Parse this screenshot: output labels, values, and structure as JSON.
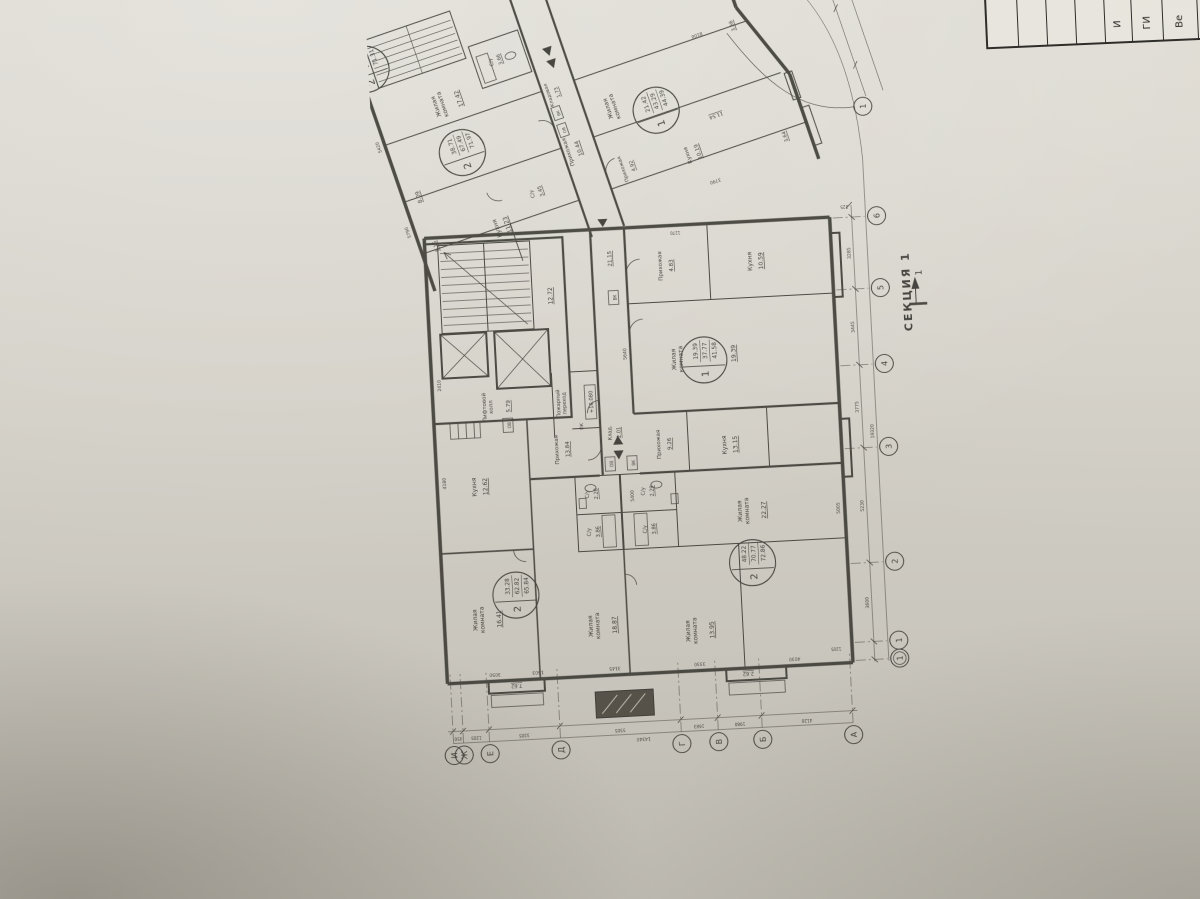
{
  "photo": {
    "paper_color": "#d3d0c7",
    "line_color": "#3a3832",
    "shadow_color": "rgba(70,63,54,0.30)"
  },
  "section": {
    "label": "СЕКЦИЯ 1",
    "mark": "1"
  },
  "title_block": {
    "cells": [
      "",
      "",
      "",
      "",
      "И",
      "ГИ",
      "Ве",
      ""
    ]
  },
  "axis_letters": [
    {
      "t": "И",
      "y": 50
    },
    {
      "t": "Ж",
      "y": 60
    },
    {
      "t": "Е",
      "y": 86
    },
    {
      "t": "Д",
      "y": 157
    },
    {
      "t": "Г",
      "y": 278
    },
    {
      "t": "В",
      "y": 315
    },
    {
      "t": "Б",
      "y": 359
    },
    {
      "t": "А",
      "y": 450
    }
  ],
  "axis_numbers": [
    {
      "t": "6",
      "x": 545
    },
    {
      "t": "5",
      "x": 473
    },
    {
      "t": "4",
      "x": 397
    },
    {
      "t": "3",
      "x": 314
    },
    {
      "t": "2",
      "x": 199
    },
    {
      "t": "1",
      "x": 120
    },
    {
      "t": "1",
      "x": 102,
      "double": true
    },
    {
      "t": "1",
      "x": 655,
      "y": 492,
      "leader": true
    }
  ],
  "stamps": [
    {
      "rooms": "2",
      "a": "33.28",
      "b": "62.82",
      "c": "65.84",
      "x": 185,
      "y": 120
    },
    {
      "rooms": "2",
      "a": "48.22",
      "b": "70.77",
      "c": "72.86",
      "x": 205,
      "y": 358
    },
    {
      "rooms": "1",
      "a": "19.39",
      "b": "37.77",
      "c": "41.58",
      "x": 410,
      "y": 320
    },
    {
      "rooms": "2",
      "a": "38.71",
      "b": "67.49",
      "c": "71.97",
      "x": 668,
      "y": 118,
      "g": "s2"
    },
    {
      "rooms": "1",
      "a": "21.42",
      "b": "43.29",
      "c": "44.39",
      "x": 645,
      "y": 315,
      "g": "s2"
    },
    {
      "rooms": "2",
      "a": "38.71",
      "b": "67.43",
      "c": "71.31",
      "x": 778,
      "y": 54,
      "g": "s2"
    }
  ],
  "plan_labels": [
    {
      "t": "Жилая\nкомната",
      "x": 162,
      "y": 80,
      "s": 6
    },
    {
      "t": "16.41",
      "x": 162,
      "y": 104,
      "s": 6,
      "u": 1
    },
    {
      "t": "Кухня",
      "x": 295,
      "y": 86,
      "s": 6
    },
    {
      "t": "12.62",
      "x": 295,
      "y": 97,
      "s": 6,
      "u": 1
    },
    {
      "t": "Жилая\nкомната",
      "x": 150,
      "y": 195,
      "s": 6
    },
    {
      "t": "18.87",
      "x": 150,
      "y": 219,
      "s": 6,
      "u": 1
    },
    {
      "t": "Прихожая",
      "x": 328,
      "y": 170,
      "s": 5.5
    },
    {
      "t": "13.84",
      "x": 328,
      "y": 181,
      "s": 5.5,
      "u": 1
    },
    {
      "t": "Жилая\nкомната",
      "x": 140,
      "y": 292,
      "s": 6
    },
    {
      "t": "13.95",
      "x": 140,
      "y": 316,
      "s": 6,
      "u": 1
    },
    {
      "t": "Жилая\nкомната",
      "x": 257,
      "y": 350,
      "s": 6
    },
    {
      "t": "22.27",
      "x": 257,
      "y": 374,
      "s": 6,
      "u": 1
    },
    {
      "t": "Кухня",
      "x": 324,
      "y": 338,
      "s": 6
    },
    {
      "t": "13.15",
      "x": 324,
      "y": 349,
      "s": 6,
      "u": 1
    },
    {
      "t": "Прихожая",
      "x": 328,
      "y": 272,
      "s": 5.5
    },
    {
      "t": "9.26",
      "x": 328,
      "y": 283,
      "s": 5.5,
      "u": 1
    },
    {
      "t": "Клад.",
      "x": 342,
      "y": 224,
      "s": 5
    },
    {
      "t": "2.01",
      "x": 342,
      "y": 233,
      "s": 5,
      "u": 1
    },
    {
      "t": "С/у",
      "x": 282,
      "y": 198,
      "s": 5
    },
    {
      "t": "2.28",
      "x": 282,
      "y": 207,
      "s": 5,
      "u": 1
    },
    {
      "t": "С/у",
      "x": 282,
      "y": 254,
      "s": 5
    },
    {
      "t": "2.29",
      "x": 282,
      "y": 263,
      "s": 5,
      "u": 1
    },
    {
      "t": "С/у",
      "x": 244,
      "y": 198,
      "s": 5
    },
    {
      "t": "3.86",
      "x": 244,
      "y": 207,
      "s": 5,
      "u": 1
    },
    {
      "t": "С/у",
      "x": 244,
      "y": 254,
      "s": 5
    },
    {
      "t": "3.86",
      "x": 244,
      "y": 263,
      "s": 5,
      "u": 1
    },
    {
      "t": "ОВ",
      "x": 311,
      "y": 224,
      "s": 4.2
    },
    {
      "t": "ВК",
      "x": 311,
      "y": 246,
      "s": 4.2
    },
    {
      "t": "ОВ",
      "x": 355,
      "y": 124,
      "s": 4.2
    },
    {
      "t": "ВК",
      "x": 477,
      "y": 236,
      "s": 4.2
    },
    {
      "t": "Лифтовой\nхолл",
      "x": 374,
      "y": 100,
      "s": 5.5
    },
    {
      "t": "5.79",
      "x": 374,
      "y": 124,
      "s": 5.5,
      "u": 1
    },
    {
      "t": "Пожарный\nпереход",
      "x": 374,
      "y": 174,
      "s": 5
    },
    {
      "t": "+16.080",
      "x": 374,
      "y": 207,
      "s": 5.2,
      "box": 1
    },
    {
      "t": "ПК",
      "x": 350,
      "y": 196,
      "s": 4.5
    },
    {
      "t": "12.72",
      "x": 482,
      "y": 172,
      "s": 6,
      "u": 1
    },
    {
      "t": "21.15",
      "x": 516,
      "y": 233,
      "s": 5.5,
      "u": 1
    },
    {
      "t": "Жилая\nкомната",
      "x": 412,
      "y": 292,
      "s": 6
    },
    {
      "t": "19.39",
      "x": 415,
      "y": 352,
      "s": 6,
      "u": 1
    },
    {
      "t": "Прихожая",
      "x": 506,
      "y": 283,
      "s": 5.5
    },
    {
      "t": "4.83",
      "x": 506,
      "y": 294,
      "s": 5.5,
      "u": 1
    },
    {
      "t": "Кухня",
      "x": 506,
      "y": 373,
      "s": 6
    },
    {
      "t": "10.59",
      "x": 506,
      "y": 384,
      "s": 6,
      "u": 1
    },
    {
      "t": "7.62",
      "x": 96,
      "y": 116,
      "s": 5,
      "u": 1,
      "r": -90
    },
    {
      "t": "2.62",
      "x": 96,
      "y": 348,
      "s": 5,
      "u": 1,
      "r": -90
    },
    {
      "t": "4180",
      "x": 300,
      "y": 56,
      "s": 4.5
    },
    {
      "t": "2410",
      "x": 398,
      "y": 56,
      "s": 4.5
    },
    {
      "t": "5640",
      "x": 420,
      "y": 243,
      "s": 4.5
    },
    {
      "t": "5400",
      "x": 278,
      "y": 243,
      "s": 4.5
    },
    {
      "t": "5005",
      "x": 255,
      "y": 448,
      "s": 4.5
    },
    {
      "t": "3050",
      "x": 108,
      "y": 95,
      "s": 4.5,
      "r": -90
    },
    {
      "t": "1503",
      "x": 108,
      "y": 138,
      "s": 4.5,
      "r": -90
    },
    {
      "t": "3145",
      "x": 108,
      "y": 215,
      "s": 4.5,
      "r": -90
    },
    {
      "t": "3330",
      "x": 108,
      "y": 300,
      "s": 4.5,
      "r": -90
    },
    {
      "t": "4030",
      "x": 108,
      "y": 395,
      "s": 4.5,
      "r": -90
    },
    {
      "t": "1205",
      "x": 116,
      "y": 437,
      "s": 4,
      "r": -90
    },
    {
      "t": "1270",
      "x": 540,
      "y": 298,
      "s": 4,
      "r": -90
    },
    {
      "t": "450",
      "x": 46,
      "y": 55,
      "s": 4.2,
      "r": -90
    },
    {
      "t": "1205",
      "x": 46,
      "y": 73,
      "s": 4.2,
      "r": -90
    },
    {
      "t": "3205",
      "x": 46,
      "y": 121,
      "s": 4.2,
      "r": -90
    },
    {
      "t": "5505",
      "x": 46,
      "y": 217,
      "s": 4.2,
      "r": -90
    },
    {
      "t": "1683",
      "x": 46,
      "y": 296,
      "s": 4.2,
      "r": -90
    },
    {
      "t": "1980",
      "x": 46,
      "y": 337,
      "s": 4.2,
      "r": -90
    },
    {
      "t": "4120",
      "x": 46,
      "y": 404,
      "s": 4.2,
      "r": -90
    },
    {
      "t": "14340",
      "x": 36,
      "y": 240,
      "s": 4.5,
      "r": -90
    },
    {
      "t": "3600",
      "x": 159,
      "y": 472,
      "s": 4.5
    },
    {
      "t": "5230",
      "x": 256,
      "y": 472,
      "s": 4.5
    },
    {
      "t": "3775",
      "x": 355,
      "y": 472,
      "s": 4.5
    },
    {
      "t": "3445",
      "x": 435,
      "y": 472,
      "s": 4.5
    },
    {
      "t": "3285",
      "x": 509,
      "y": 472,
      "s": 4.5
    },
    {
      "t": "19320",
      "x": 330,
      "y": 486,
      "s": 4.5
    },
    {
      "t": "225",
      "x": 557,
      "y": 468,
      "s": 4,
      "r": -90
    },
    {
      "t": "8.09",
      "x": 640,
      "y": 64,
      "s": 5.5,
      "u": 1,
      "g": "s2"
    },
    {
      "t": "5.15",
      "x": 588,
      "y": 64,
      "s": 5,
      "u": 1,
      "g": "s2"
    },
    {
      "t": "Кухня",
      "x": 585,
      "y": 128,
      "s": 6,
      "g": "s2"
    },
    {
      "t": "11.23",
      "x": 585,
      "y": 139,
      "s": 6,
      "u": 1,
      "g": "s2"
    },
    {
      "t": "С/у",
      "x": 606,
      "y": 172,
      "s": 5,
      "g": "s2"
    },
    {
      "t": "3.45",
      "x": 606,
      "y": 181,
      "s": 5,
      "u": 1,
      "g": "s2"
    },
    {
      "t": "Прихожая",
      "x": 634,
      "y": 220,
      "s": 5.5,
      "g": "s2"
    },
    {
      "t": "10.44",
      "x": 634,
      "y": 231,
      "s": 5.5,
      "u": 1,
      "g": "s2"
    },
    {
      "t": "Кладовая",
      "x": 694,
      "y": 220,
      "s": 4.8,
      "g": "s2"
    },
    {
      "t": "1.73",
      "x": 694,
      "y": 229,
      "s": 4.8,
      "u": 1,
      "g": "s2"
    },
    {
      "t": "С/у",
      "x": 744,
      "y": 176,
      "s": 5,
      "g": "s2"
    },
    {
      "t": "3.66",
      "x": 744,
      "y": 185,
      "s": 5,
      "u": 1,
      "g": "s2"
    },
    {
      "t": "Жилая\nкомната",
      "x": 720,
      "y": 110,
      "s": 6,
      "g": "s2"
    },
    {
      "t": "17.42",
      "x": 720,
      "y": 134,
      "s": 6,
      "u": 1,
      "g": "s2"
    },
    {
      "t": "Прихожая",
      "x": 600,
      "y": 266,
      "s": 5,
      "g": "s2"
    },
    {
      "t": "4.92",
      "x": 600,
      "y": 276,
      "s": 5,
      "u": 1,
      "g": "s2"
    },
    {
      "t": "Жилая\nкомната",
      "x": 662,
      "y": 272,
      "s": 6,
      "g": "s2"
    },
    {
      "t": "Кухня",
      "x": 592,
      "y": 332,
      "s": 5.5,
      "g": "s2"
    },
    {
      "t": "10.19",
      "x": 592,
      "y": 343,
      "s": 5.5,
      "u": 1,
      "g": "s2"
    },
    {
      "t": "11.54",
      "x": 622,
      "y": 370,
      "s": 5,
      "u": 1,
      "r": -90,
      "g": "s2"
    },
    {
      "t": "3.64",
      "x": 578,
      "y": 430,
      "s": 5,
      "u": 1,
      "g": "s2"
    },
    {
      "t": "3.66",
      "x": 700,
      "y": 416,
      "s": 5,
      "u": 1,
      "g": "s2"
    },
    {
      "t": "ОВ",
      "x": 656,
      "y": 223,
      "s": 4,
      "g": "s2"
    },
    {
      "t": "ВК",
      "x": 674,
      "y": 223,
      "s": 4,
      "g": "s2"
    },
    {
      "t": "5790",
      "x": 610,
      "y": 42,
      "s": 4.5,
      "g": "s2"
    },
    {
      "t": "5420",
      "x": 700,
      "y": 42,
      "s": 4.5,
      "g": "s2"
    },
    {
      "t": "3880",
      "x": 758,
      "y": 42,
      "s": 4.5,
      "g": "s2"
    },
    {
      "t": "8100",
      "x": 704,
      "y": 378,
      "s": 4.5,
      "r": -90,
      "g": "s2"
    },
    {
      "t": "3790",
      "x": 560,
      "y": 348,
      "s": 4.5,
      "r": -90,
      "g": "s2"
    }
  ]
}
